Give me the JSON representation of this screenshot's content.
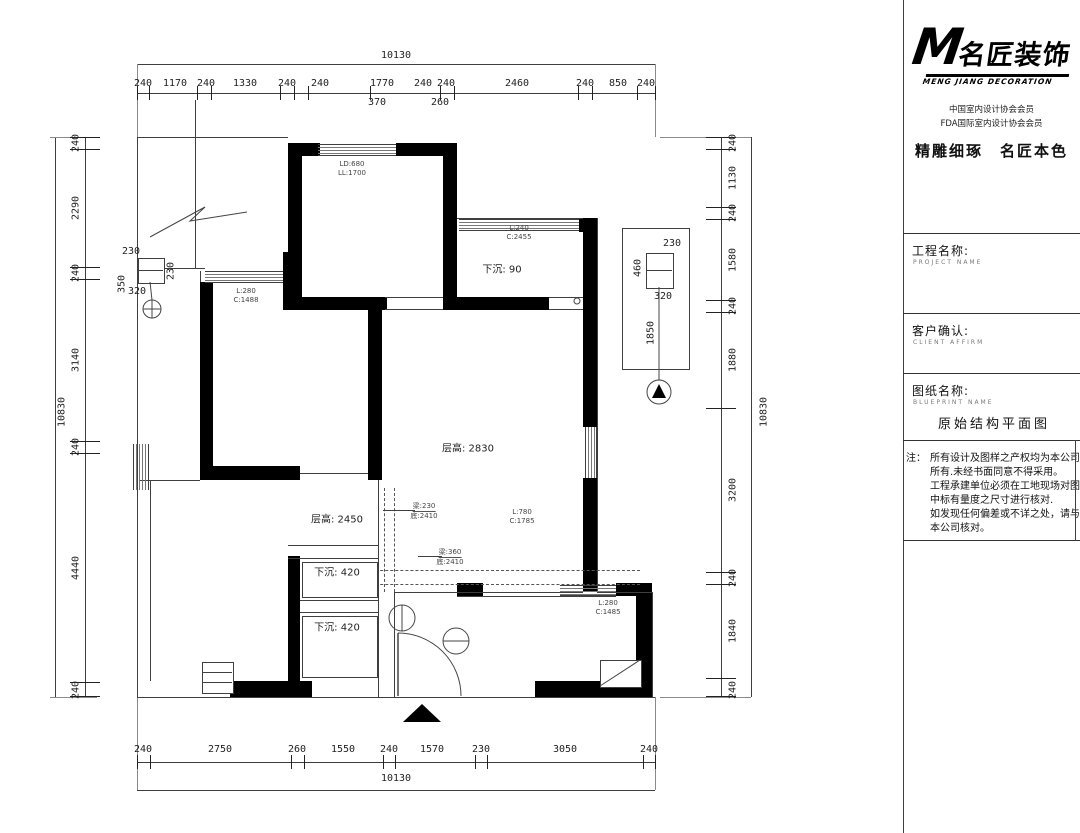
{
  "plan": {
    "totals": {
      "top": "10130",
      "bottom": "10130",
      "left": "10830",
      "right": "10830"
    },
    "top_chain": [
      "240",
      "1170",
      "240",
      "1330",
      "240",
      "240",
      "1770",
      "240",
      "240",
      "2460",
      "240",
      "850",
      "240"
    ],
    "top_sub": {
      "a": "370",
      "b": "260"
    },
    "bottom_chain": [
      "240",
      "2750",
      "260",
      "1550",
      "240",
      "1570",
      "230",
      "3050",
      "240"
    ],
    "left_chain": [
      "240",
      "2290",
      "240",
      "3140",
      "240",
      "4440",
      "240"
    ],
    "right_chain": [
      "240",
      "1130",
      "240",
      "1580",
      "240",
      "1880",
      "3200",
      "240",
      "1840",
      "240"
    ],
    "labels": {
      "sunken_90": "下沉: 90",
      "ceiling_2830": "层高: 2830",
      "ceiling_2450": "层高: 2450",
      "sunken_420a": "下沉: 420",
      "sunken_420b": "下沉: 420"
    },
    "annotations": {
      "win_tl_1": "L:280",
      "win_tl_2": "C:1488",
      "win_tr_1": "L:240",
      "win_tr_2": "C:2455",
      "win_mid_1": "L:780",
      "win_mid_2": "C:1785",
      "win_br_1": "L:280",
      "win_br_2": "C:1485",
      "beam1_1": "梁:230",
      "beam1_2": "底:2410",
      "beam2_1": "梁:360",
      "beam2_2": "底:2410",
      "door_top_1": "LD:680",
      "door_top_2": "LL:1700"
    },
    "shaft_right": {
      "d1": "230",
      "d2": "460",
      "d3": "320",
      "d4": "1850"
    },
    "shaft_left": {
      "d1": "230",
      "d2": "230",
      "d3": "350",
      "d4": "320"
    }
  },
  "title_block": {
    "logo_m": "M",
    "logo_cn": "名匠装饰",
    "logo_en": "MENG JIANG DECORATION",
    "member1": "中国室内设计协会会员",
    "member2": "FDA国际室内设计协会会员",
    "slogan": "精雕细琢　名匠本色",
    "project_label": "工程名称:",
    "project_en": "PROJECT NAME",
    "client_label": "客户确认:",
    "client_en": "CLIENT AFFIRM",
    "drawing_label": "图纸名称:",
    "drawing_en": "BLUEPRINT NAME",
    "drawing_name": "原始结构平面图",
    "note_label": "注：",
    "note_lines": [
      "所有设计及图样之产权均为本公司",
      "所有.未经书面同意不得采用。",
      "工程承建单位必须在工地现场对图",
      "中标有量度之尺寸进行核对.",
      "如发现任何偏差或不详之处，请与",
      "本公司核对。"
    ]
  }
}
